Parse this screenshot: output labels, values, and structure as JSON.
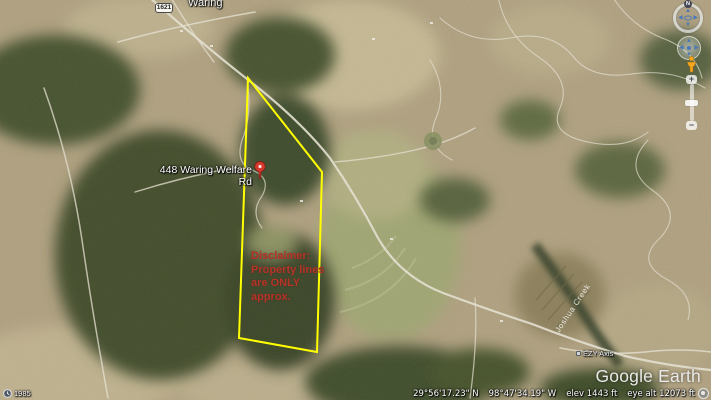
{
  "map": {
    "town_label": "Waring",
    "road_shield": "1621",
    "pin_label": "448 Waring Welfare Rd",
    "disclaimer_lines": [
      "Disclaimer:",
      "Property lines",
      "are ONLY",
      "approx."
    ],
    "creek_label": "Joshua Creek",
    "place_label": "EZY Axis",
    "colors": {
      "boundary_yellow": "#ffff00",
      "disclaimer_red": "#b73529",
      "pin_red": "#d6382b"
    }
  },
  "time_indicator": {
    "year": "1985"
  },
  "status_bar": {
    "latitude": "29°56'17.23\" N",
    "longitude": "98°47'34.19\" W",
    "elevation": "elev 1443 ft",
    "eye_altitude": "eye alt 12073 ft"
  },
  "branding": {
    "logo": "Google Earth"
  },
  "nav": {
    "north_label": "N",
    "zoom_in": "+",
    "zoom_out": "−",
    "arrow_up": "▲",
    "arrow_down": "▼",
    "arrow_left": "◀",
    "arrow_right": "▶"
  }
}
